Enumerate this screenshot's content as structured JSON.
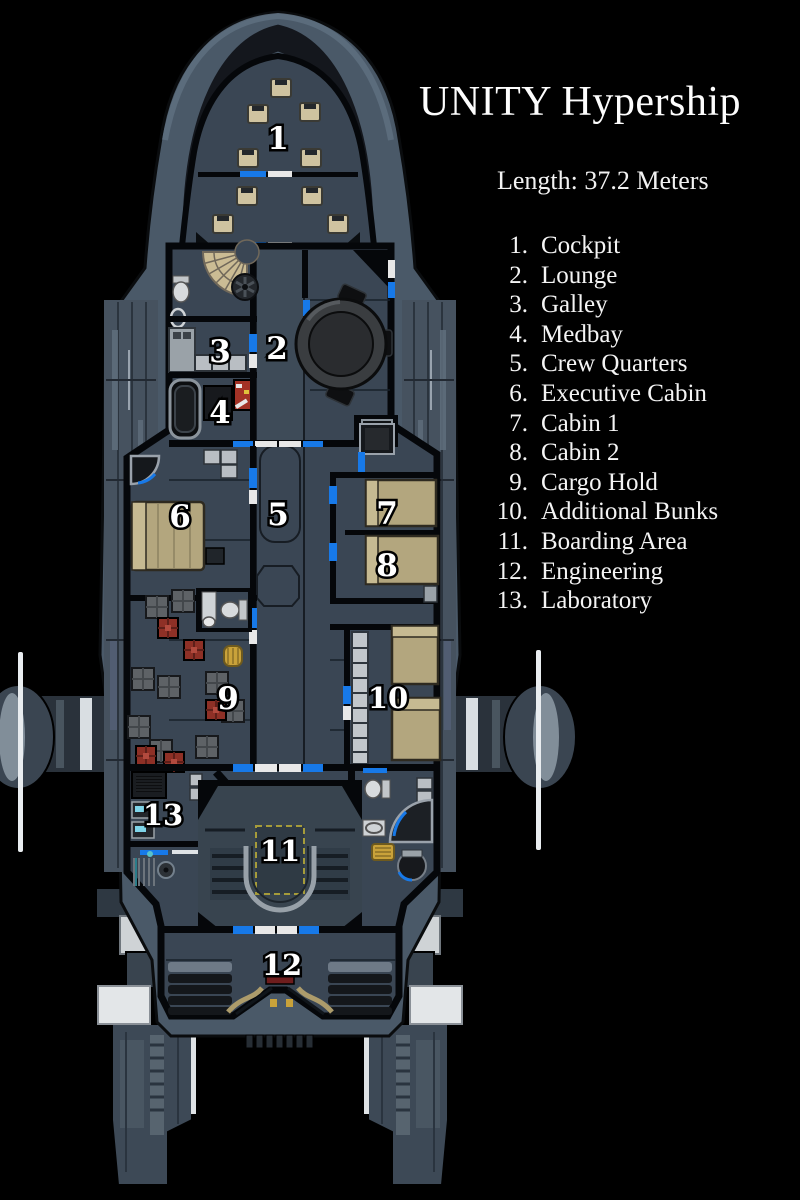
{
  "title": "UNITY Hypership",
  "spec": {
    "length_label": "Length: 37.2 Meters"
  },
  "legend": {
    "items": [
      {
        "num": "1.",
        "label": "Cockpit"
      },
      {
        "num": "2.",
        "label": "Lounge"
      },
      {
        "num": "3.",
        "label": "Galley"
      },
      {
        "num": "4.",
        "label": "Medbay"
      },
      {
        "num": "5.",
        "label": "Crew Quarters"
      },
      {
        "num": "6.",
        "label": "Executive Cabin"
      },
      {
        "num": "7.",
        "label": "Cabin 1"
      },
      {
        "num": "8.",
        "label": "Cabin 2"
      },
      {
        "num": "9.",
        "label": "Cargo  Hold"
      },
      {
        "num": "10.",
        "label": "Additional Bunks"
      },
      {
        "num": "11.",
        "label": "Boarding Area"
      },
      {
        "num": "12.",
        "label": "Engineering"
      },
      {
        "num": "13.",
        "label": "Laboratory"
      }
    ]
  },
  "map": {
    "labels": [
      {
        "text": "1"
      },
      {
        "text": "2"
      },
      {
        "text": "3"
      },
      {
        "text": "4"
      },
      {
        "text": "5"
      },
      {
        "text": "6"
      },
      {
        "text": "7"
      },
      {
        "text": "8"
      },
      {
        "text": "9"
      },
      {
        "text": "10"
      },
      {
        "text": "11"
      },
      {
        "text": "12"
      },
      {
        "text": "13"
      }
    ]
  },
  "colors": {
    "background": "#000000",
    "hull": "#4a5968",
    "deck": "#3a4654",
    "wall": "#05070a",
    "door_blue": "#1779e8",
    "door_white": "#e8e8e8",
    "bed_tan": "#b3a67e",
    "crate_red": "#8e3026",
    "crate_gray": "#5e6266",
    "hazard_yellow": "#a59b3a",
    "text": "#ffffff"
  }
}
